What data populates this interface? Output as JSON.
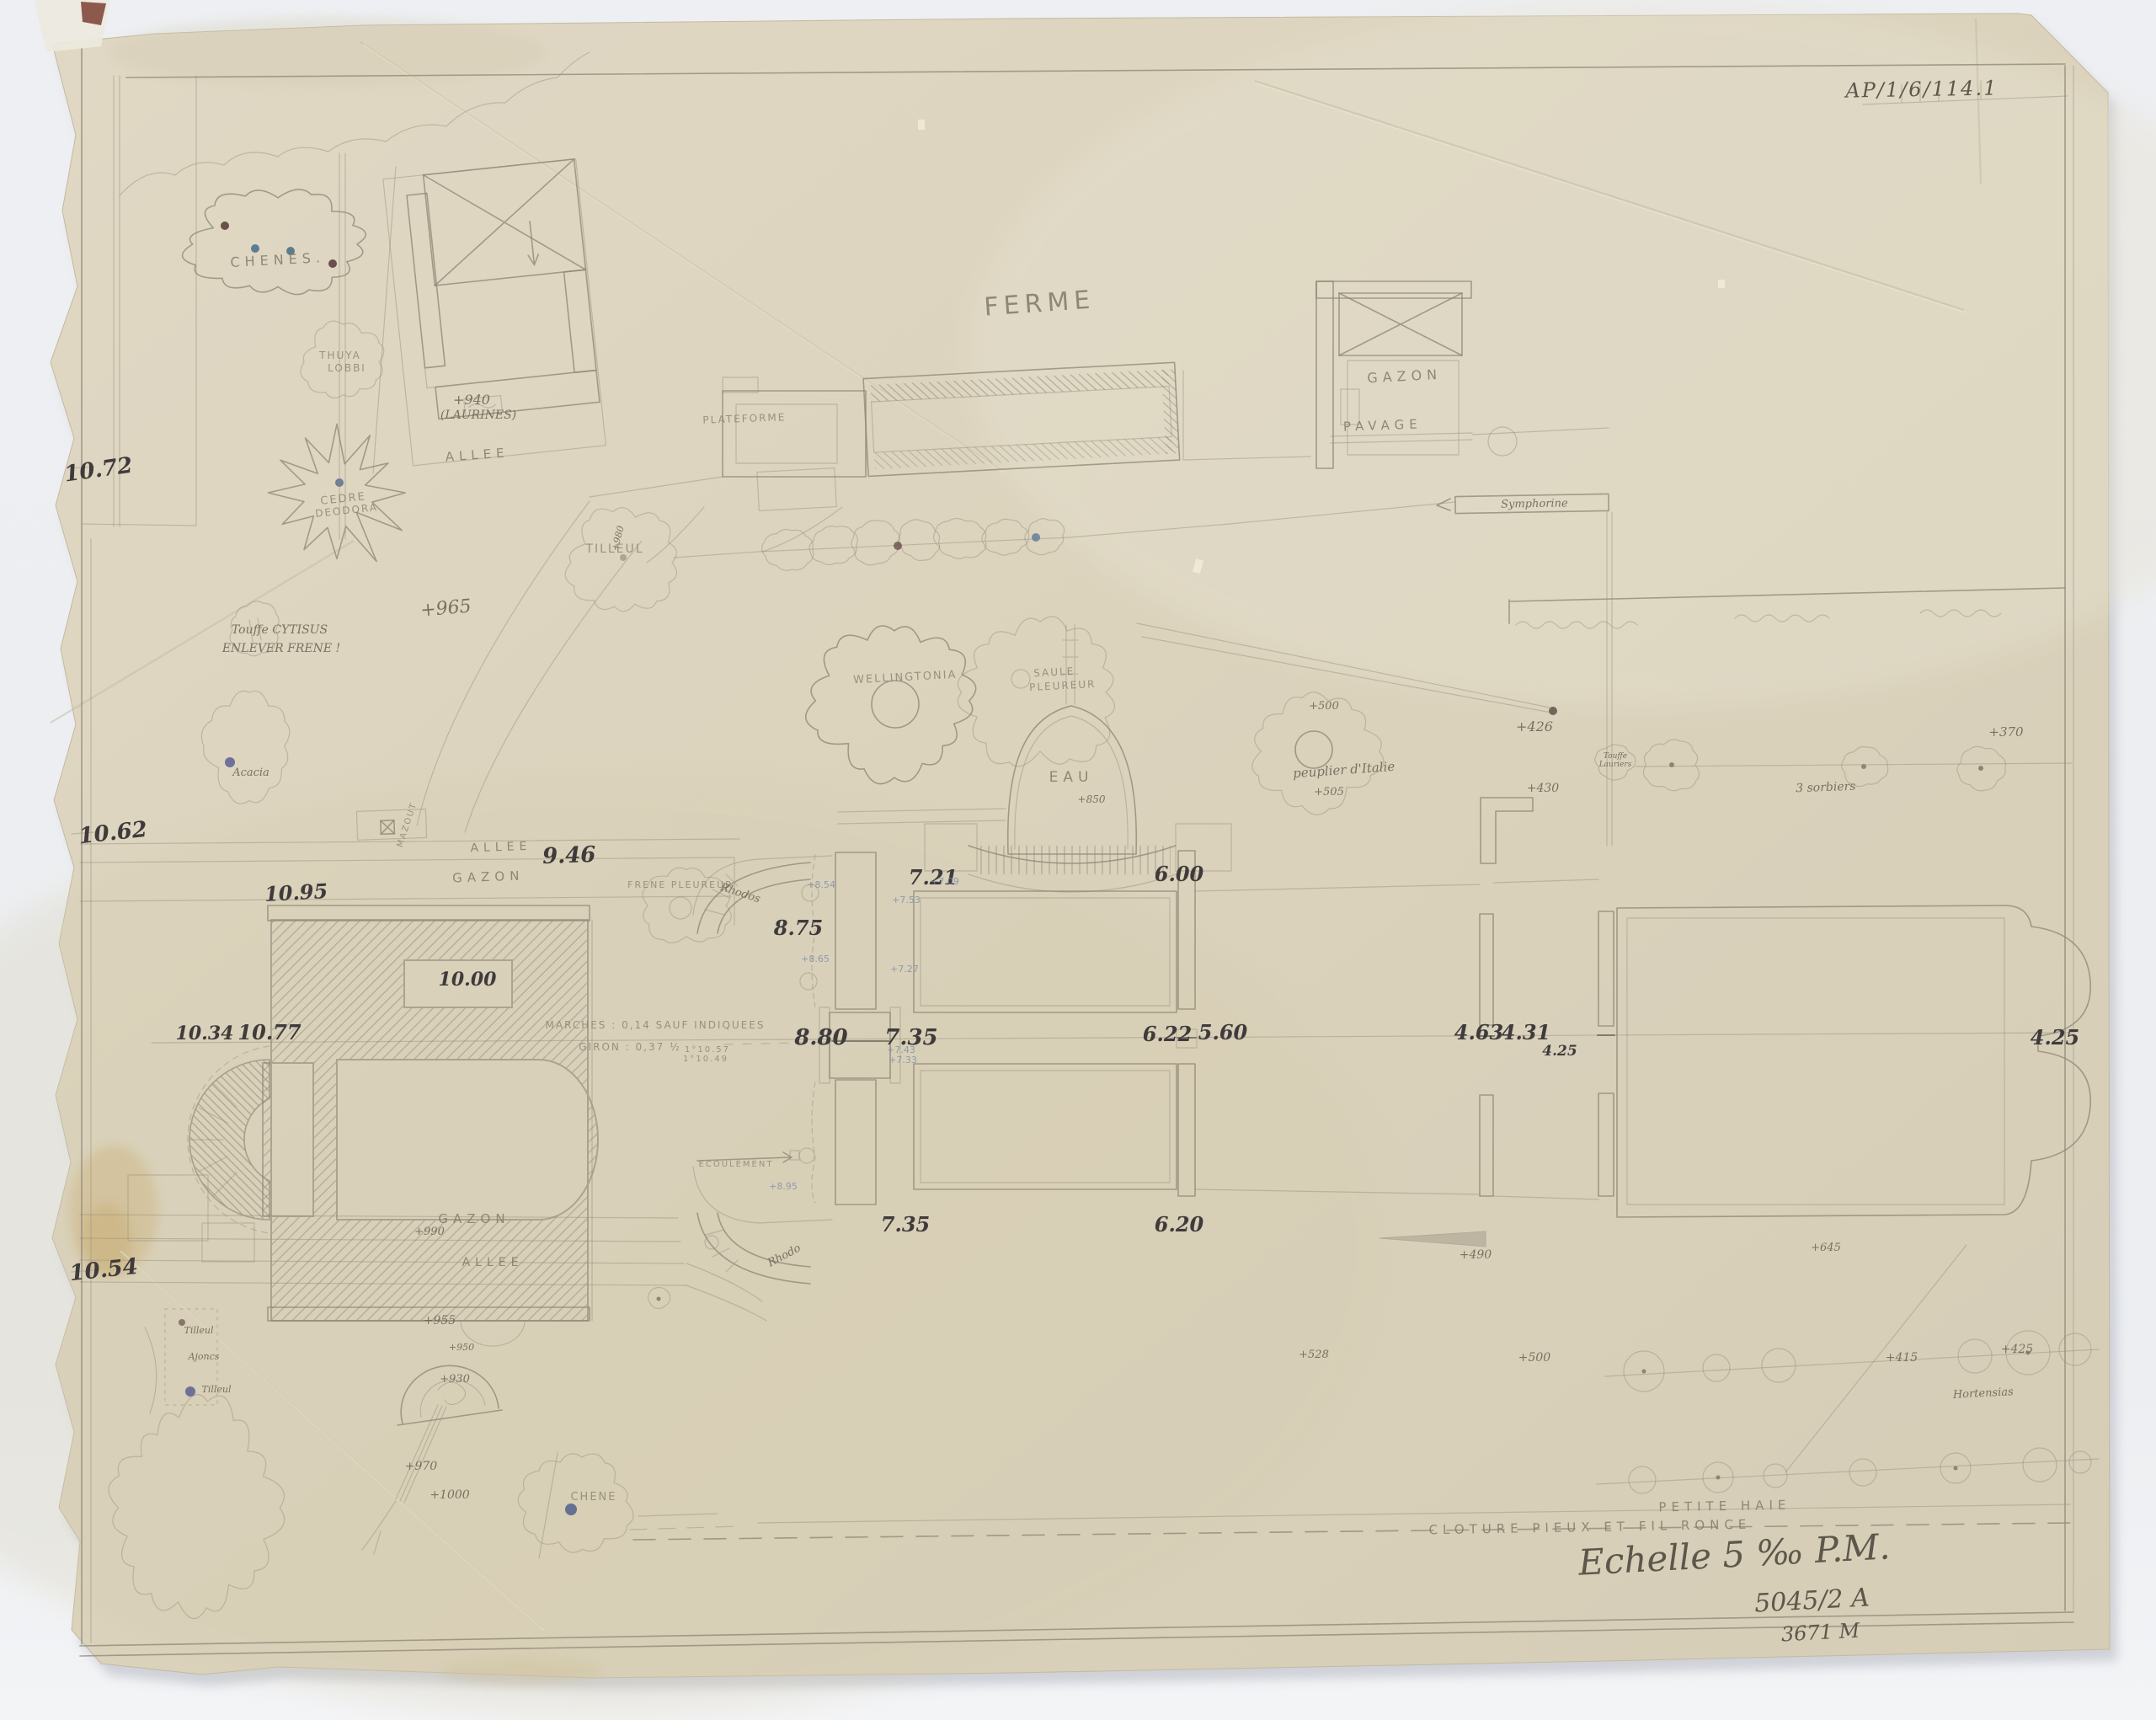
{
  "archive_mark": "AP/1/6/114.1",
  "title_block": {
    "scale": "Echelle 5 ‰ P.M.",
    "plan_number": "5045/2 A",
    "reference": "3671 M"
  },
  "palette": {
    "paper": "#ddd5bf",
    "pencil": "#8d8576",
    "ink": "#3f3b3c",
    "blue_note": "#7b8fa8",
    "background": "#eef0f3"
  },
  "plan_labels": {
    "ferme": "FERME",
    "plateforme": "PLATEFORME",
    "gazon_farm": "GAZON",
    "pavage": "PAVAGE",
    "chenes": "CHENES.",
    "thuya_1": "THUYA",
    "thuya_2": "LOBBI",
    "laurines_level": "+940",
    "laurines": "(LAURINES)",
    "allee_nw": "ALLEE",
    "cedre_1": "CEDRE",
    "cedre_2": "DEODORA",
    "cytisus": "Touffe CYTISUS",
    "enlever": "ENLEVER FRENE !",
    "acacia": "Acacia",
    "tilleul_big": "TILLEUL",
    "tilleul_level": "+980",
    "symphorine": "Symphorine",
    "peuplier": "peuplier d'Italie",
    "touffe_1": "Touffe",
    "touffe_2": "Lauriers",
    "sorbiers": "3 sorbiers",
    "wellingtonia": "WELLINGTONIA",
    "saule_1": "SAULE",
    "saule_2": "PLEUREUR",
    "eau": "EAU",
    "frene_pleureur": "FRENE PLEUREUR",
    "allee_top": "ALLEE",
    "gazon_top": "GAZON",
    "mazout": "MAZOUT",
    "marches": "MARCHES : 0,14 SAUF INDIQUEES",
    "giron": "GIRON : 0,37 ½",
    "giron_2": "1°10.57",
    "giron_3": "1°10.49",
    "ecoulement": "ECOULEMENT",
    "rhodo_north": "Rhodos",
    "rhodo_south": "Rhodo",
    "gazon_bottom": "GAZON",
    "allee_bottom": "ALLEE",
    "chene": "CHENE",
    "tilleul_sw_1": "Tilleul",
    "ajoncs": "Ajoncs",
    "tilleul_sw_2": "Tilleul",
    "hortensias": "Hortensias",
    "petite_haie": "PETITE HAIE",
    "cloture": "CLOTURE   PIEUX   ET FIL RONCE"
  },
  "levels": {
    "n1072": "10.72",
    "n1062": "10.62",
    "n1054": "10.54",
    "n946": "9.46",
    "n1095": "10.95",
    "n1000": "10.00",
    "n1034": "10.34",
    "n1077": "10.77",
    "n875": "8.75",
    "n880": "8.80",
    "n735": "7.35",
    "n721": "7.21",
    "n600": "6.00",
    "n622": "6.22",
    "n560": "5.60",
    "n463": "4.63",
    "n431": "4.31",
    "n425_small": "4.25",
    "n425_right": "4.25",
    "n735_s": "7.35",
    "n620": "6.20",
    "p965": "+965",
    "p500": "+500",
    "p505": "+505",
    "p426": "+426",
    "p430": "+430",
    "p370": "+370",
    "p850": "+850",
    "p990": "+990",
    "p955": "+955",
    "p950": "+950",
    "p930": "+930",
    "p970": "+970",
    "p1000": "+1000",
    "p490": "+490",
    "p528": "+528",
    "p645": "+645",
    "p500b": "+500",
    "p415": "+415",
    "p425b": "+425",
    "b854": "+8.54",
    "b865": "+8.65",
    "b709": "+7.09",
    "b753": "+7.53",
    "b727": "+7.27",
    "b743": "+7.43",
    "b733": "+7.33",
    "b895": "+8.95"
  }
}
